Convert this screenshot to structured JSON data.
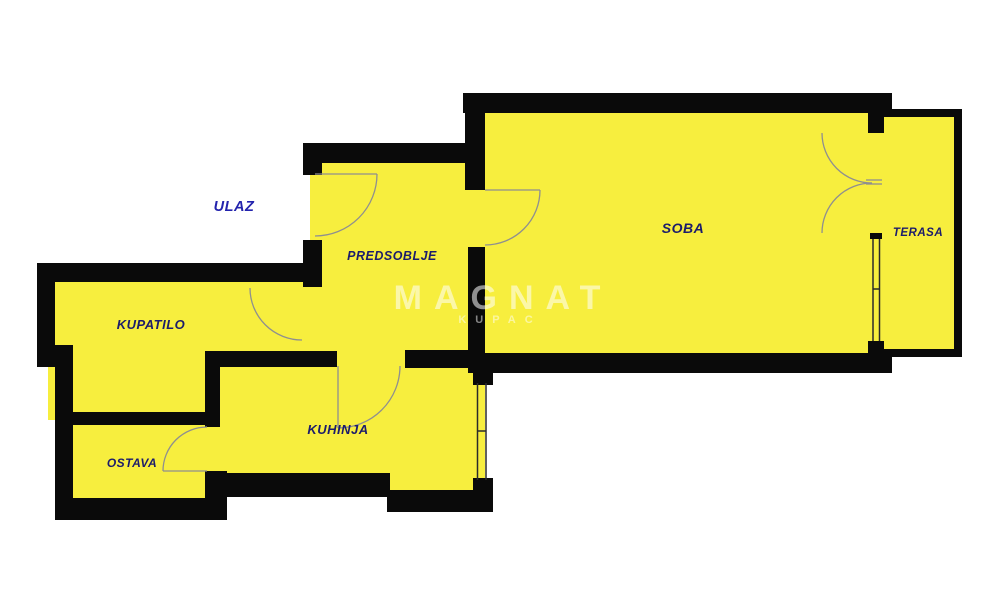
{
  "title": "Apartment floor plan",
  "colors": {
    "floor": "#f7ee3e",
    "wall": "#0a0a0a",
    "label": "#1c1c6b",
    "ulaz_label": "#2323ad",
    "door_line": "#8f8f8f",
    "window_line": "#2a2a2a",
    "watermark": "#ffffff",
    "background": "#ffffff"
  },
  "rooms": {
    "ulaz": {
      "label": "ULAZ"
    },
    "predsoblje": {
      "label": "PREDSOBLJE"
    },
    "kupatilo": {
      "label": "KUPATILO"
    },
    "soba": {
      "label": "SOBA"
    },
    "terasa": {
      "label": "TERASA"
    },
    "ostava": {
      "label": "OSTAVA"
    },
    "kuhinja": {
      "label": "KUHINJA"
    }
  },
  "watermark": {
    "line1": "MAGNAT",
    "line2": "KUPAC"
  }
}
